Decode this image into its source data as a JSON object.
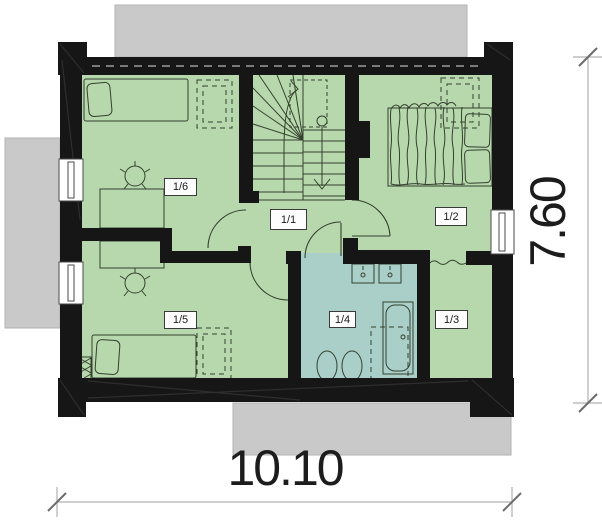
{
  "plan": {
    "room_labels": [
      "1/1",
      "1/2",
      "1/3",
      "1/4",
      "1/5",
      "1/6"
    ]
  },
  "dimensions": {
    "width_m": "10.10",
    "depth_m": "7.60"
  },
  "colors": {
    "floor_green": "#b6d8ac",
    "bath_teal": "#a9cfc8",
    "wall_black": "#161616",
    "roof_gray": "#c9c9c9"
  }
}
